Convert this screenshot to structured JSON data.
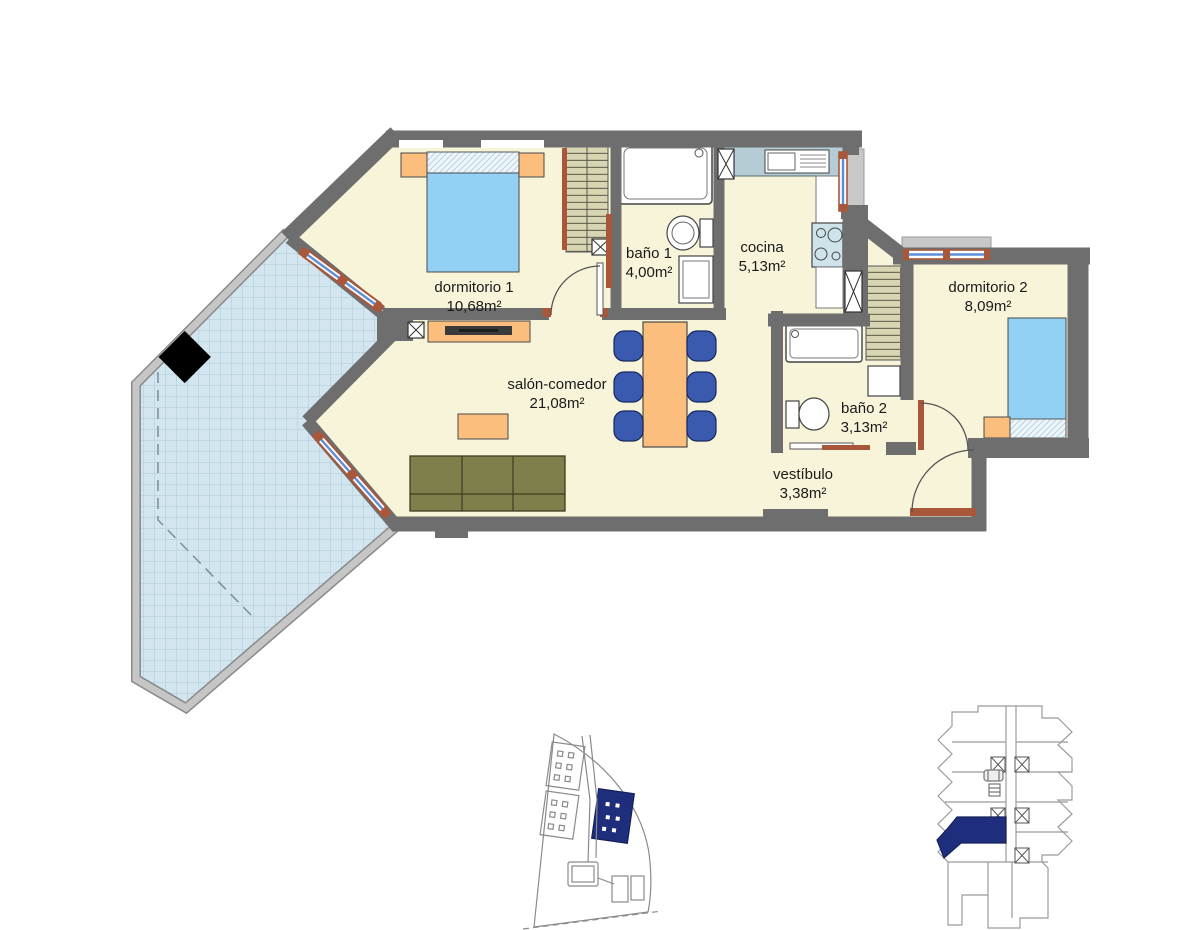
{
  "title": "Apartment floor plan",
  "rooms": [
    {
      "name": "dormitorio 1",
      "area": "10,68m²"
    },
    {
      "name": "baño 1",
      "area": "4,00m²"
    },
    {
      "name": "cocina",
      "area": "5,13m²"
    },
    {
      "name": "salón-comedor",
      "area": "21,08m²"
    },
    {
      "name": "dormitorio 2",
      "area": "8,09m²"
    },
    {
      "name": "baño 2",
      "area": "3,13m²"
    },
    {
      "name": "vestíbulo",
      "area": "3,38m²"
    }
  ],
  "colors": {
    "wall": "#6e6e6e",
    "floor": "#f8f4da",
    "terrace_tile": "#d3e5ee",
    "railing": "#c4c4c4",
    "bed_blue": "#92d1f4",
    "furniture_orange": "#fbbe7d",
    "sofa_olive": "#7f7f4b",
    "chair_blue": "#3a5ab0",
    "window_frame": "#a9573b",
    "window_glass": "#5b8fd9",
    "highlight_navy": "#1f2e7c"
  }
}
